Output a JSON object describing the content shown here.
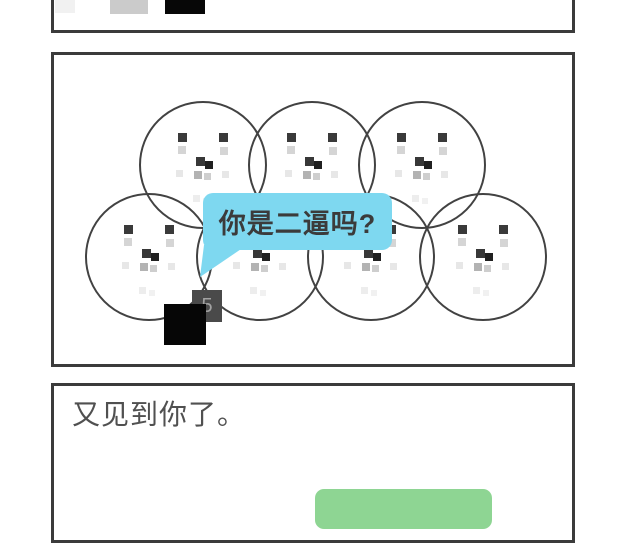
{
  "page": {
    "background": "#ffffff",
    "ink": "#3b3b3b"
  },
  "panel_top": {
    "squares": [
      {
        "name": "faded-square",
        "x": 1,
        "w": 20,
        "h": 22,
        "color": "#f1f1f1"
      },
      {
        "name": "gray-square",
        "x": 56,
        "w": 38,
        "h": 23,
        "color": "#cbcbcb"
      },
      {
        "name": "black-square",
        "x": 111,
        "w": 40,
        "h": 23,
        "color": "#070707"
      }
    ]
  },
  "panel_scene": {
    "svg_w": 518,
    "svg_h": 309,
    "circle_radius": 63,
    "circle_stroke": "#424242",
    "circle_stroke_width": 2,
    "circles": [
      {
        "cx": 149,
        "cy": 110
      },
      {
        "cx": 258,
        "cy": 110
      },
      {
        "cx": 368,
        "cy": 110
      },
      {
        "cx": 95,
        "cy": 202
      },
      {
        "cx": 206,
        "cy": 202
      },
      {
        "cx": 317,
        "cy": 202
      },
      {
        "cx": 429,
        "cy": 202
      }
    ],
    "face_pixels": [
      {
        "part": "eye-left",
        "dx": -25,
        "dy": -32,
        "s": 9,
        "c": "#3a3a3a"
      },
      {
        "part": "eye-right",
        "dx": 16,
        "dy": -32,
        "s": 9,
        "c": "#3a3a3a"
      },
      {
        "part": "cheek-left",
        "dx": -25,
        "dy": -19,
        "s": 8,
        "c": "#d5d5d5"
      },
      {
        "part": "cheek-right",
        "dx": 17,
        "dy": -18,
        "s": 8,
        "c": "#d5d5d5"
      },
      {
        "part": "nose-1",
        "dx": -7,
        "dy": -8,
        "s": 9,
        "c": "#383838"
      },
      {
        "part": "nose-2",
        "dx": 2,
        "dy": -4,
        "s": 8,
        "c": "#202020"
      },
      {
        "part": "mouth-1",
        "dx": -27,
        "dy": 5,
        "s": 7,
        "c": "#e7e7e7"
      },
      {
        "part": "mouth-2",
        "dx": -9,
        "dy": 6,
        "s": 8,
        "c": "#b3b3b3"
      },
      {
        "part": "mouth-3",
        "dx": 1,
        "dy": 8,
        "s": 7,
        "c": "#cecece"
      },
      {
        "part": "mouth-4",
        "dx": 19,
        "dy": 6,
        "s": 7,
        "c": "#e7e7e7"
      },
      {
        "part": "chin-1",
        "dx": -10,
        "dy": 30,
        "s": 7,
        "c": "#ededed"
      },
      {
        "part": "chin-2",
        "dx": 0,
        "dy": 33,
        "s": 6,
        "c": "#f1f1f1"
      }
    ],
    "bubble": {
      "text": "你是二逼吗?",
      "bg": "#7ed8f0",
      "text_color": "#3b3b3b",
      "x": 149,
      "y": 138,
      "w": 189,
      "h": 57
    },
    "bubble_tail_points": "150,190 193,190 146,222",
    "tile": {
      "label": "5",
      "bg": "#4a4a4a",
      "text_color": "#a2a2a2",
      "x": 138,
      "y": 235,
      "w": 30,
      "h": 32
    },
    "black_square": {
      "x": 110,
      "y": 249,
      "w": 42,
      "h": 41,
      "color": "#060606"
    }
  },
  "panel_caption": {
    "text": "又见到你了。",
    "text_color": "#505050",
    "button": {
      "color": "#8ed593"
    }
  }
}
